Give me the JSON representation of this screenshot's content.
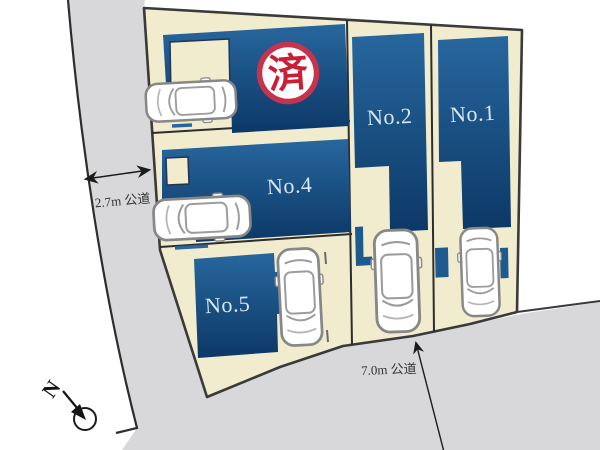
{
  "diagram_title": "residential-lot-layout",
  "plots": [
    {
      "id": "no1",
      "label": "No.1",
      "status": "available"
    },
    {
      "id": "no2",
      "label": "No.2",
      "status": "available"
    },
    {
      "id": "no4",
      "label": "No.4",
      "status": "available"
    },
    {
      "id": "no5",
      "label": "No.5",
      "status": "available"
    },
    {
      "id": "sold",
      "label": "済",
      "status": "sold"
    }
  ],
  "roads": [
    {
      "id": "left-road",
      "width_label": "2.7m 公道"
    },
    {
      "id": "bottom-road",
      "width_label": "7.0m 公道"
    }
  ],
  "compass": {
    "north_label": "N"
  },
  "colors": {
    "background": "#ffffff",
    "road": "#d8d8da",
    "parcel": "#f1ecce",
    "building_top": "#27679e",
    "building_bottom": "#0c3866",
    "accent_blue": "#1d5a8e",
    "outline": "#2d2d2d",
    "plot_label_text": "#d8e7f4",
    "badge_ring": "#c5334d",
    "badge_text": "#c81f37",
    "road_label_text": "#333333"
  }
}
